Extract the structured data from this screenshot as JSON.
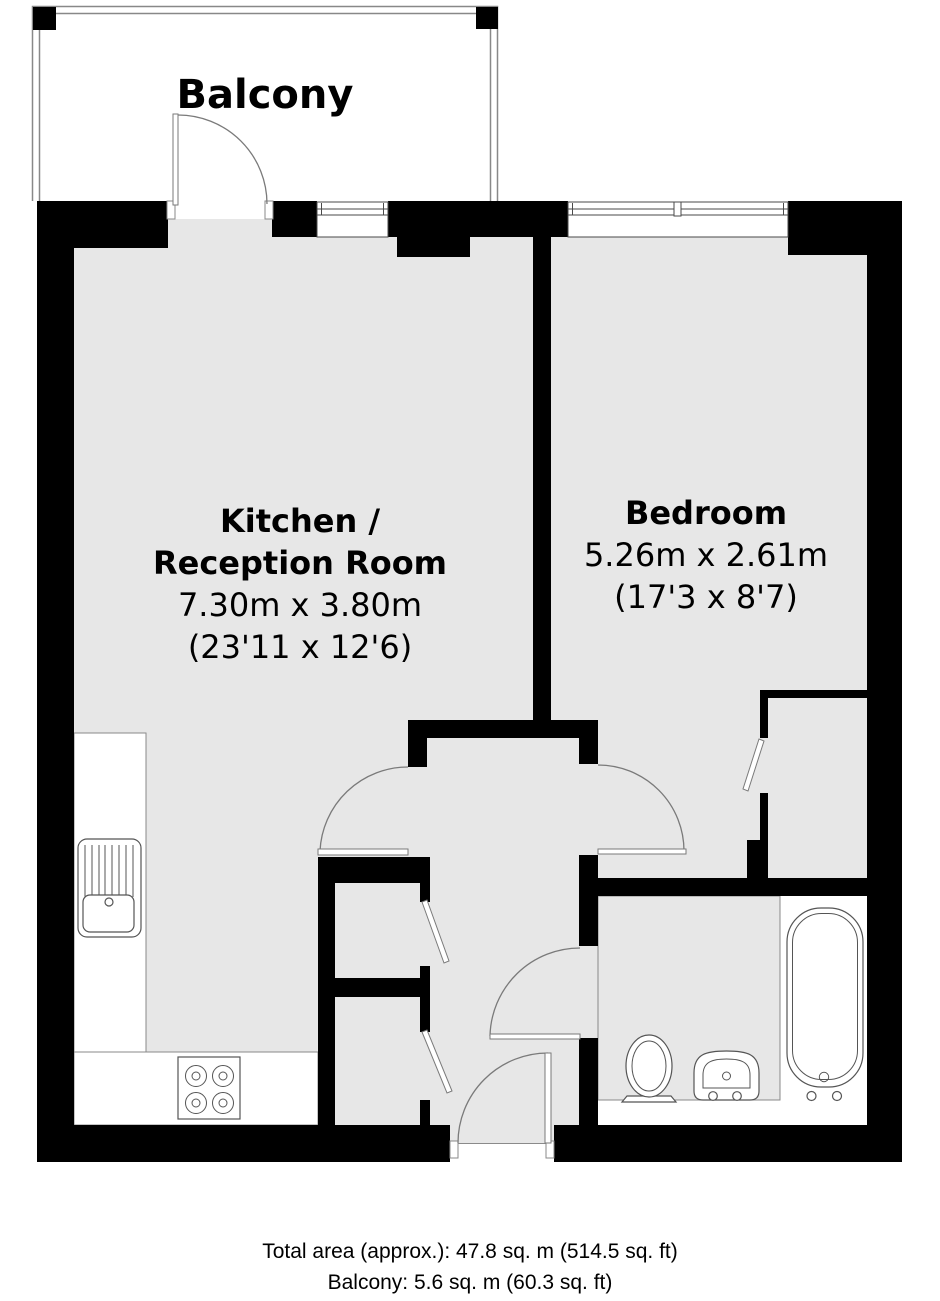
{
  "balcony": {
    "label": "Balcony"
  },
  "kitchen": {
    "name_line1": "Kitchen /",
    "name_line2": "Reception Room",
    "dims_metric": "7.30m x 3.80m",
    "dims_imperial": "(23'11 x 12'6)"
  },
  "bedroom": {
    "name": "Bedroom",
    "dims_metric": "5.26m x 2.61m",
    "dims_imperial": "(17'3 x 8'7)"
  },
  "footer": {
    "total_area": "Total area (approx.): 47.8 sq. m (514.5 sq. ft)",
    "balcony_area": "Balcony: 5.6 sq. m (60.3 sq. ft)"
  },
  "colors": {
    "wall": "#000000",
    "floor": "#e7e7e7",
    "line": "#8a8a8a"
  }
}
